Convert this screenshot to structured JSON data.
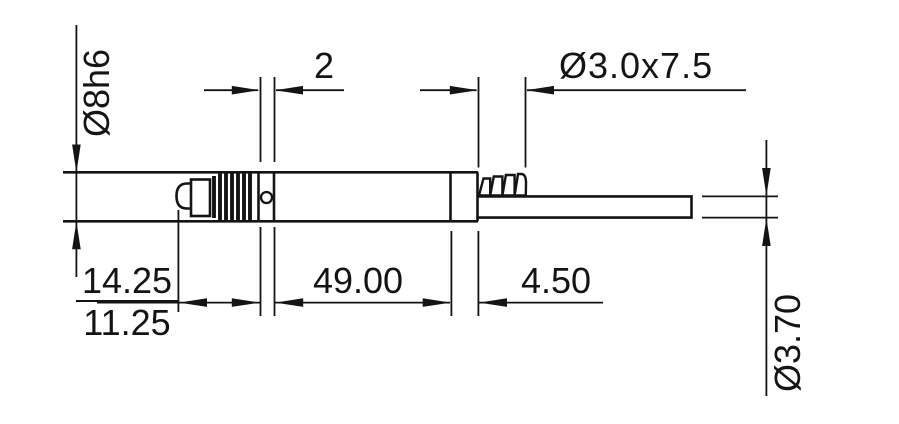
{
  "drawing": {
    "colors": {
      "line": "#141414",
      "background": "#ffffff"
    },
    "dimensions": {
      "body_diameter": "Ø8h6",
      "groove_width": "2",
      "barb_fitting": "Ø3.0x7.5",
      "tip_dim_upper": "14.25",
      "tip_dim_lower": "11.25",
      "body_length": "49.00",
      "fitting_length": "4.50",
      "cable_diameter": "Ø3.70"
    }
  }
}
